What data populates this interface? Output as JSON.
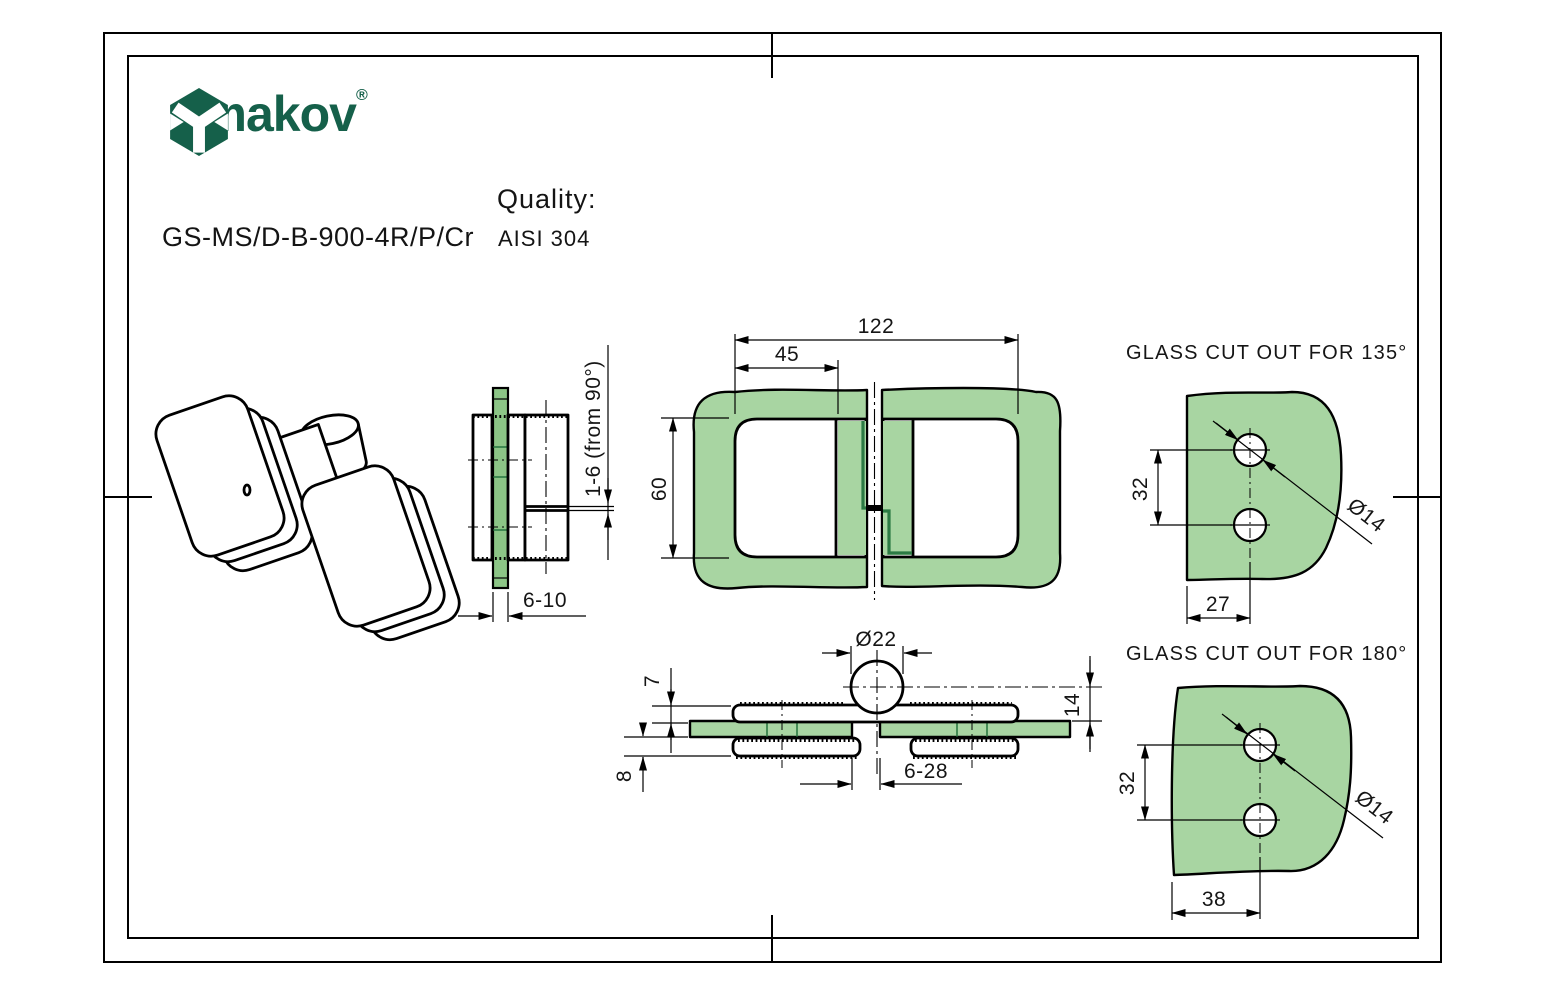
{
  "header": {
    "brand": "umakov",
    "registered": "®",
    "part_number": "GS-MS/D-B-900-4R/P/Cr",
    "quality_label": "Quality:",
    "quality_value": "AISI 304"
  },
  "colors": {
    "brand_green": "#15604a",
    "glass_fill": "#a8d5a2",
    "glass_fill_dark": "#8cc586",
    "plate_edge_on_glass": "#2c7a44",
    "line": "#000000",
    "background": "#ffffff"
  },
  "views": {
    "top": {
      "dim_overall_width": "122",
      "dim_cutout_offset": "45",
      "dim_height": "60"
    },
    "side": {
      "dim_adjustment": "1-6 (from 90°)",
      "dim_glass_thickness": "6-10"
    },
    "front": {
      "dim_knuckle_diameter": "Ø22",
      "dim_plate_above": "7",
      "dim_plate_below": "8",
      "dim_axis_height": "14",
      "dim_gap": "6-28"
    },
    "cutout135": {
      "title": "GLASS CUT OUT FOR 135°",
      "dim_hole_spacing": "32",
      "dim_edge_offset": "27",
      "dim_hole_diameter": "Ø14"
    },
    "cutout180": {
      "title": "GLASS CUT OUT FOR 180°",
      "dim_hole_spacing": "32",
      "dim_edge_offset": "38",
      "dim_hole_diameter": "Ø14"
    }
  }
}
